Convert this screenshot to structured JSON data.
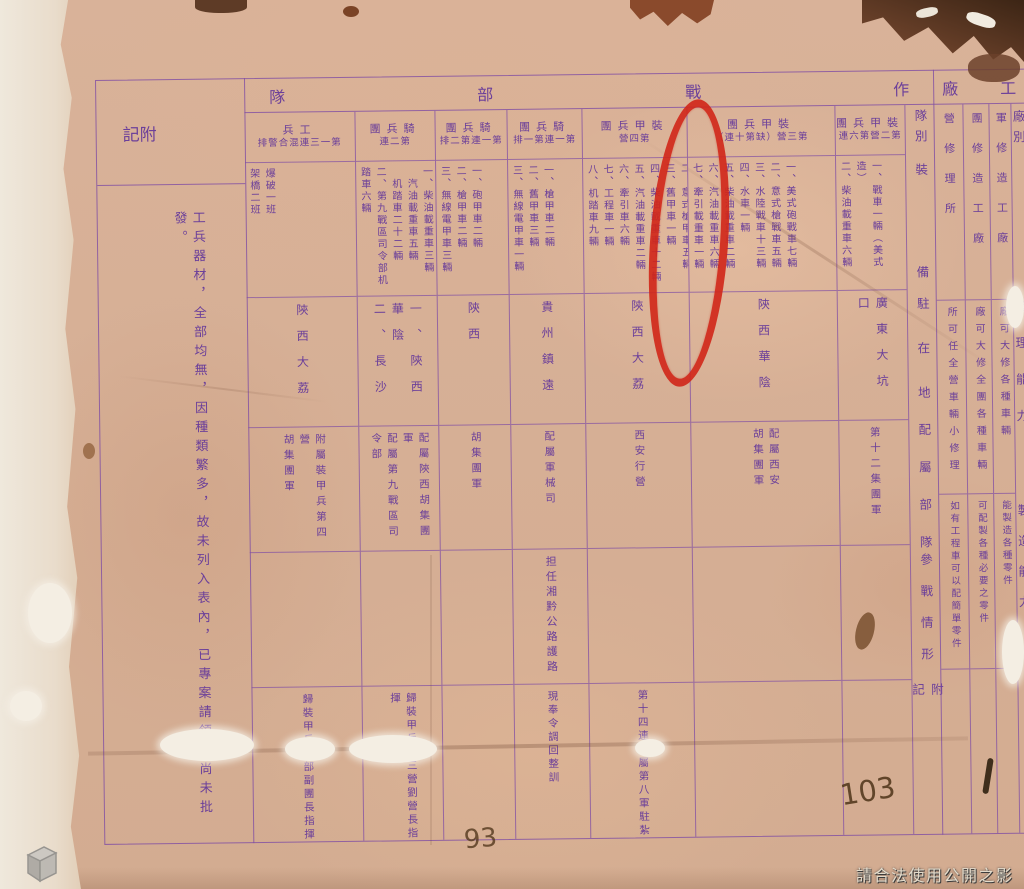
{
  "document": {
    "left_note": {
      "header": "附記",
      "content": "工兵器材，全部均無，因種類繁多，故未列入表內，已專案請領，尚未批發。"
    },
    "combat_section": {
      "title": "作戰部隊",
      "row_labels": [
        "隊別",
        "裝備",
        "駐在地",
        "配屬部隊",
        "參戰情形",
        "附記"
      ],
      "units": [
        {
          "name": "裝甲兵團",
          "sub": "第二營第六連",
          "equipment": "一、戰車一輛（美式造）\n二、柴油載重車六輛",
          "location": "廣東大坑口",
          "attached": "第十二集團軍",
          "combat": "",
          "remark": ""
        },
        {
          "name": "裝甲兵團",
          "sub": "第三營（缺第十連）",
          "equipment": "一、美式砲戰車七輛\n二、意式槍戰車五輛\n三、水陸戰車十三輛\n四、水車一輛\n五、柴油載重車二輛\n六、汽油載重車六輛\n七、牽引載重車一輛",
          "location": "陝西華陰",
          "attached": "配屬西安\n胡集團軍",
          "combat": "",
          "remark": ""
        },
        {
          "name": "裝甲兵團",
          "sub": "第四營",
          "equipment": "一、俄式砲戰車一八輛\n二、意式槍甲車五輛\n三、舊甲車一輛\n四、柴油載重車十二輛\n五、汽油載重車二輛\n六、牽引車六輛\n七、工程車一輛\n八、机踏車九輛",
          "location": "陝西大荔",
          "attached": "西安行營",
          "combat": "",
          "remark": "第十四連配屬第八軍駐紮"
        },
        {
          "name": "騎兵團",
          "sub": "第一連第一排",
          "equipment": "一、槍甲車二輛\n二、舊甲車三輛\n三、無線電甲車一輛",
          "location": "貴州鎮遠",
          "attached": "配屬軍械司",
          "combat": "担任湘黔公路護路",
          "remark": "現奉令調回整訓"
        },
        {
          "name": "騎兵團",
          "sub": "第一連第二排",
          "equipment": "一、砲甲車二輛\n二、槍甲車二輛\n三、無線電甲車三輛",
          "location": "陝西",
          "attached": "胡集團軍",
          "combat": "",
          "remark": ""
        },
        {
          "name": "騎兵團",
          "sub": "第二連",
          "equipment": "一、柴油載重車三輛\n　汽油載重車五輛\n　机踏車二十二輛\n二、第九戰區司令部机踏車六輛",
          "location": "一、陝西華陰\n二、長沙",
          "attached": "配屬陝西胡集團軍\n配屬第九戰區司令部",
          "combat": "",
          "remark": "歸裝甲兵團三營劉營長指揮"
        },
        {
          "name": "工兵",
          "sub": "第一三連混合警排",
          "equipment": "爆破一班\n架橋二班",
          "location": "陝西大荔",
          "attached": "附屬裝甲兵第四營\n胡集團軍",
          "combat": "",
          "remark": "歸裝甲兵團部副團長指揮"
        }
      ]
    },
    "factory_section": {
      "title": "工廠",
      "row_labels": [
        "廠別",
        "修理能力",
        "製造能力"
      ],
      "factories": [
        {
          "name": "軍修造工廠",
          "repair": "廠可大修各種車輛",
          "manufacture": "能製造各種零件"
        },
        {
          "name": "團修造工廠",
          "repair": "廠可大修全團各種車輛",
          "manufacture": "可配製各種必要之零件"
        },
        {
          "name": "營修理所",
          "repair": "所可任全營車輛小修理",
          "manufacture": "如有工程車可以配簡單零件"
        }
      ]
    },
    "annotations": {
      "page_number_right": "103",
      "page_number_bottom": "93",
      "watermark": "請合法使用公開之影像"
    }
  },
  "colors": {
    "ink": "#6b3f9a",
    "grid_line": "#804ea4",
    "red_circle": "#d02618",
    "paper": "#d9b299",
    "handwritten_number": "#4e3418"
  }
}
